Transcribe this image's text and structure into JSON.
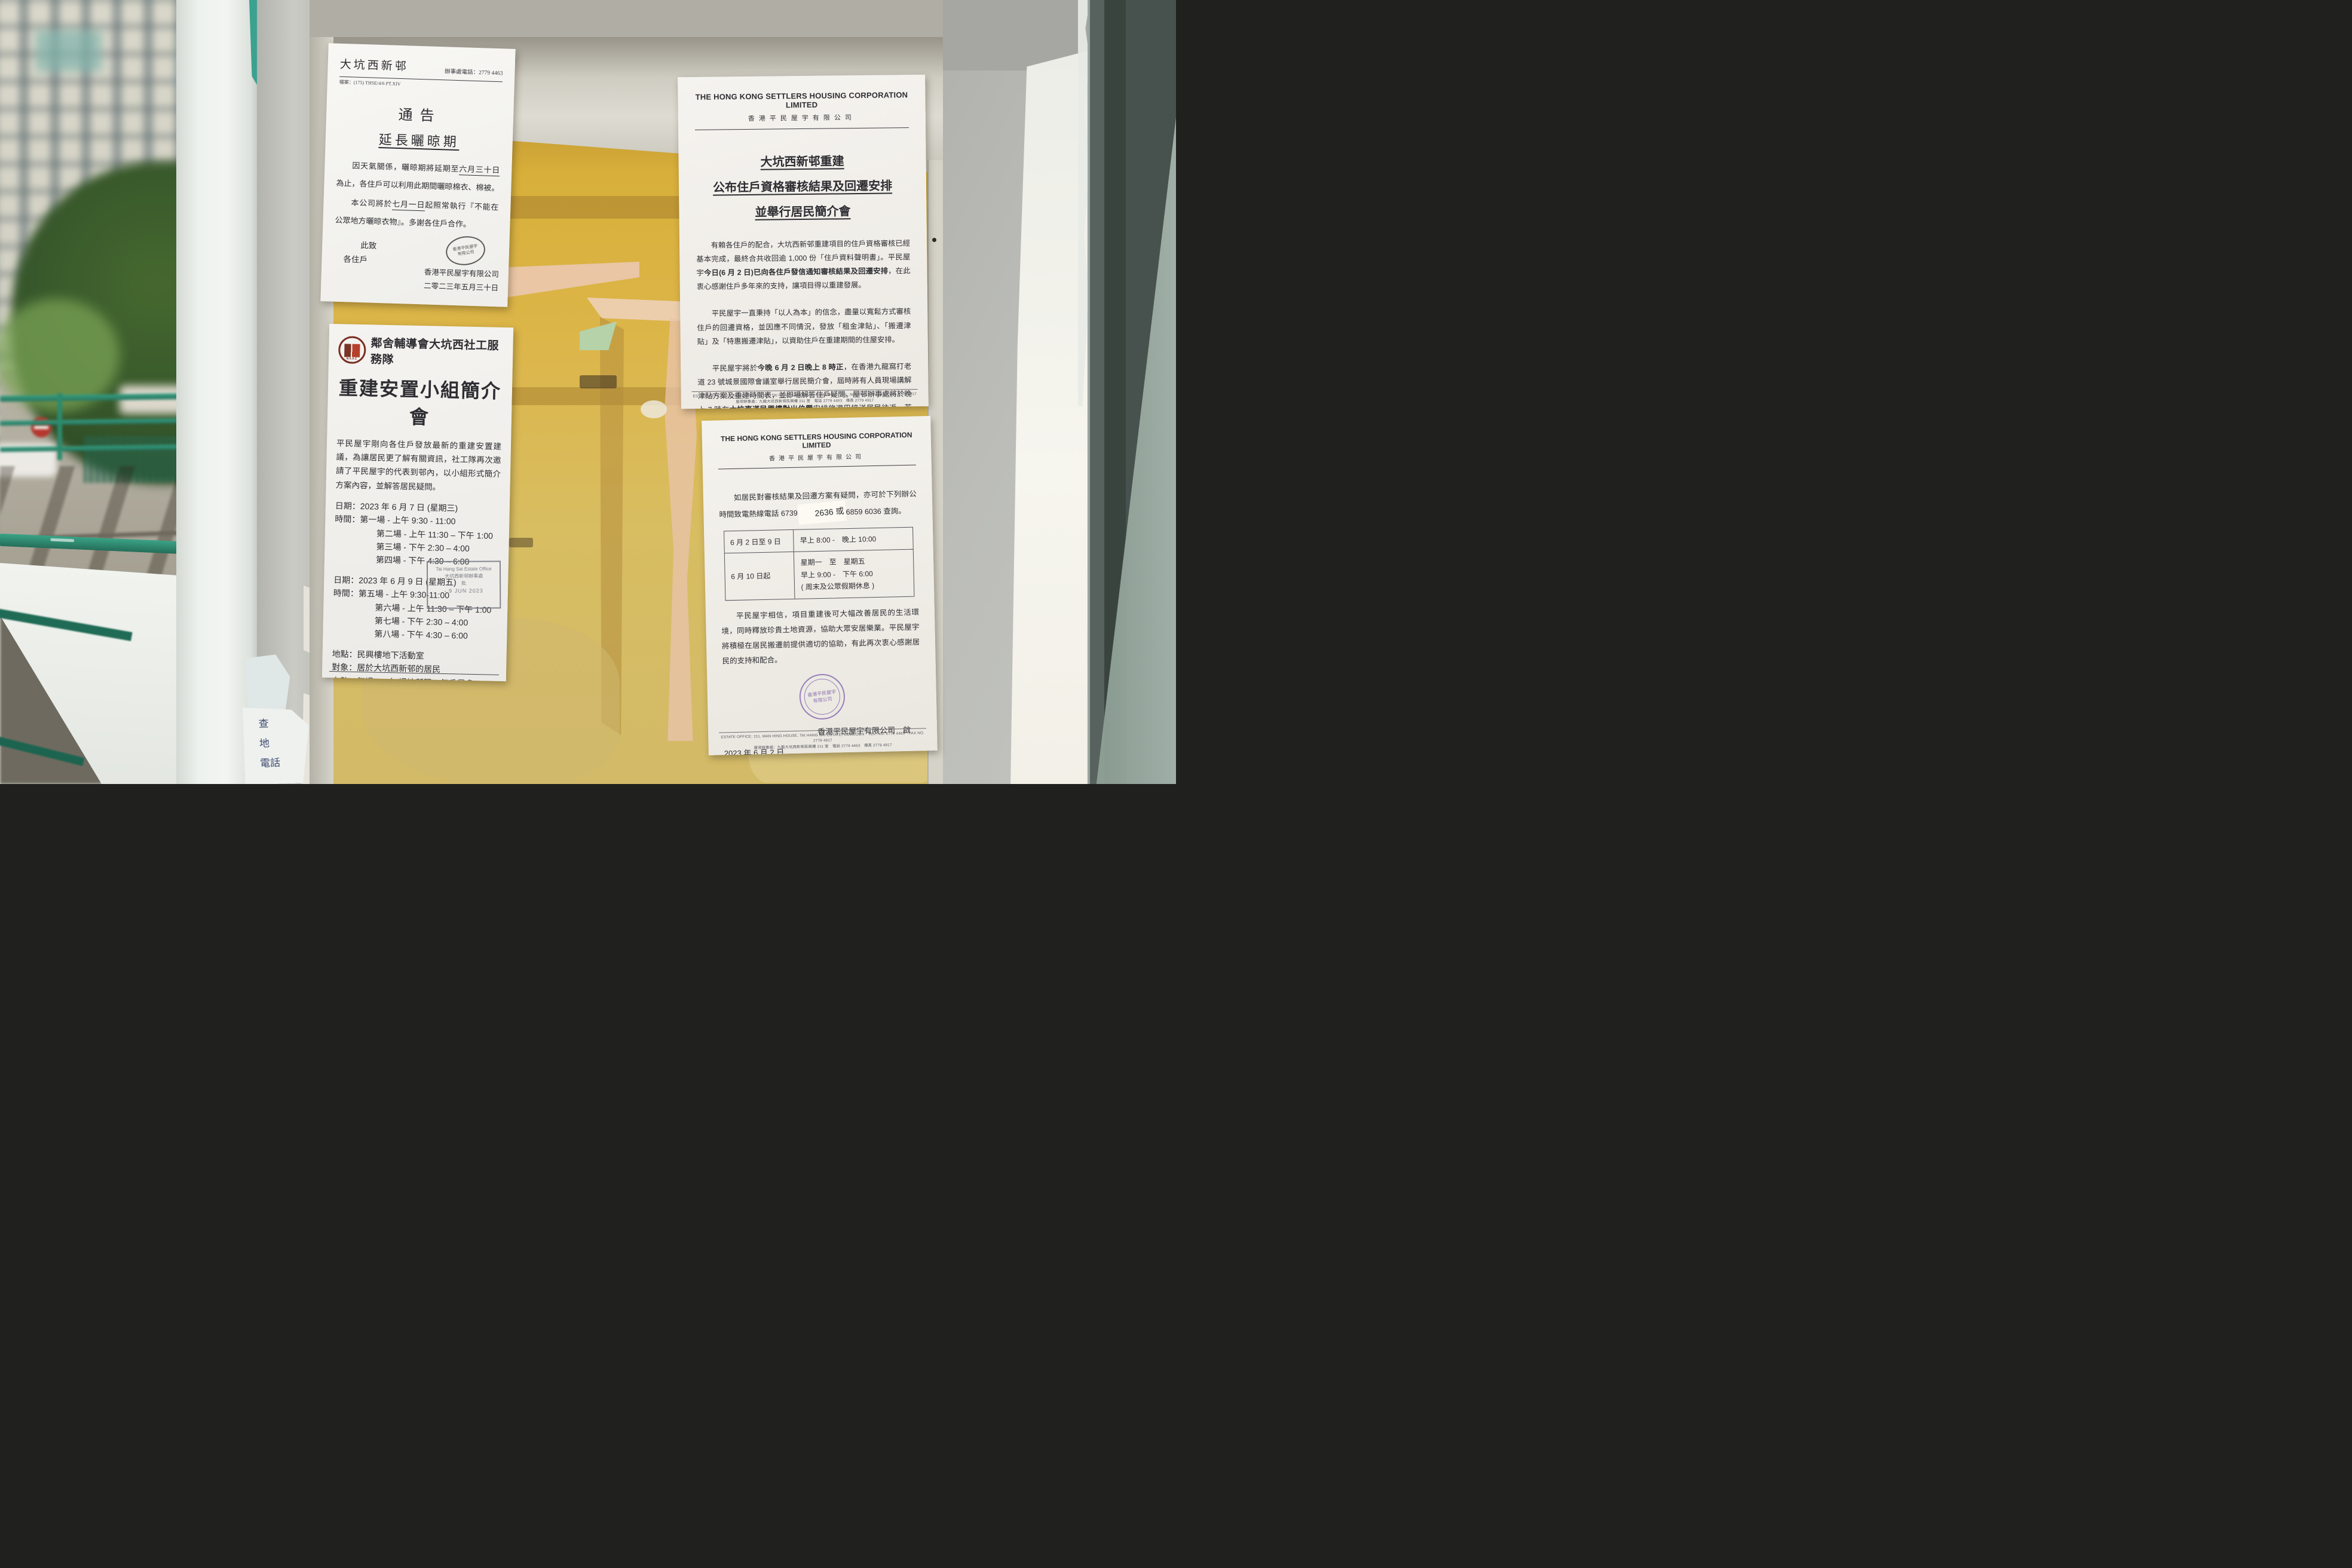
{
  "colors": {
    "board_yellow": "#dcb64a",
    "railing_green": "#2e8f72",
    "paper_white": "#f6f5f1",
    "stamp_black": "#3f3f3f",
    "stamp_purple": "#7b5ea6",
    "no_entry_red": "#b5372f",
    "doorframe_teal": "#47524e"
  },
  "notice_drying": {
    "estate_name": "大坑西新邨",
    "office_phone": "辦事處電話：2779 4463",
    "file_ref": "檔案：(175) THSE/4/6 PT.XIV",
    "title": "通告",
    "subtitle": "延長曬晾期",
    "p1_pre": "因天氣關係，曬晾期將延期至",
    "p1_underline": "六月三十日",
    "p1_post": "為止，各住戶可以利用此期間曬晾棉衣、棉被。",
    "p2_pre": "本公司將於",
    "p2_underline": "七月一日",
    "p2_post": "起照常執行『不能在公眾地方曬晾衣物』。多謝各住戶合作。",
    "closing_1": "此致",
    "closing_2": "各住戶",
    "stamp_line1": "香港平民屋宇",
    "stamp_line2": "有限公司",
    "signature": "香港平民屋宇有限公司",
    "date": "二零二三年五月三十日"
  },
  "notice_briefing": {
    "org": "鄰舍輔導會大坑西社工服務隊",
    "logo_caption": "NAAC",
    "title": "重建安置小組簡介會",
    "intro": "平民屋宇剛向各住戶發放最新的重建安置建議，為讓居民更了解有關資訊，社工隊再次邀請了平民屋宇的代表到邨內，以小組形式簡介方案內容，並解答居民疑問。",
    "day1_date": "日期：2023 年 6 月 7 日 (星期三)",
    "day1_sessions": [
      "時間：第一場 - 上午 9:30 - 11:00",
      "第二場 - 上午 11:30 – 下午 1:00",
      "第三場 - 下午 2:30 – 4:00",
      "第四場 - 下午 4:30 – 6:00"
    ],
    "day2_date": "日期：2023 年 6 月 9 日 (星期五)",
    "day2_sessions": [
      "時間：第五場 - 上午 9:30-11:00",
      "第六場 - 上午 11:30 – 下午 1:00",
      "第七場 - 下午 2:30 – 4:00",
      "第八場 - 下午 4:30 – 6:00"
    ],
    "venue": "地點：民興樓地下活動室",
    "audience": "對象：居於大坑西新邨的居民",
    "capacity_pre": "人數：每場 35 人(場地所限，每戶最多 2 人，",
    "capacity_boxed": "請先預約",
    "capacity_post": ")",
    "note": "註　：未有出席 6 月 5 日簡介會之住戶，可優先出席。",
    "enquiry": "查詢及預約：",
    "address": "地址：九龍深水埗大坑西新邨民樂樓 116 室",
    "phone": "電話：9719 9107",
    "stamp": {
      "line1": "Tai Hang Sai Estate Office",
      "line2": "大坑西新邨辦事處",
      "line3": "批",
      "line4": "- 9 JUN 2023"
    }
  },
  "notice_results": {
    "org_en": "THE HONG KONG SETTLERS HOUSING CORPORATION LIMITED",
    "org_zh": "香港平民屋宇有限公司",
    "title_l1": "大坑西新邨重建",
    "title_l2": "公布住戶資格審核結果及回遷安排",
    "title_l3": "並舉行居民簡介會",
    "p1_pre": "有賴各住戶的配合，大坑西新邨重建項目的住戶資格審核已經基本完成，最終合共收回逾 1,000 份「住戶資料聲明書」。平民屋宇",
    "p1_bold": "今日(6 月 2 日)已向各住戶發信通知審核結果及回遷安排",
    "p1_post": "，在此衷心感謝住戶多年來的支持，讓項目得以重建發展。",
    "p2": "平民屋宇一直秉持「以人為本」的信念，盡量以寬鬆方式審核住戶的回遷資格，並因應不同情況，發放「租金津貼」、「搬遷津貼」及「特惠搬遷津貼」，以資助住戶在重建期間的住屋安排。",
    "p3_pre": "平民屋宇將於",
    "p3_bold1": "今晚 6 月 2 日晚上 8 時正",
    "p3_mid": "，在香港九龍窩打老道 23 號城景國際會議室舉行居民簡介會，屆時將有人員現場講解津貼方案及重建時間表，並即場解答住戶疑問。屋邨辦事處將於晚上 7 時在",
    "p3_bold2": "大坑東道民興樓對出位置",
    "p3_post": "安排旅遊巴接送居民往返。若需了解進一步詳情，可與屋邨辦事處聯絡，電話 2779 4463。",
    "footer_en": "ESTATE OFFICE: 211, MAN HING HOUSE, TAI HANG SAI ESTATE, KOWLOON　TEL. NO. 2779 4463　FAX NO. 2779 4917",
    "footer_zh": "屋邨辦事處：九龍大坑西新邨民興樓 211 室　電話 2779 4463　傳真 2779 4917"
  },
  "notice_hotline": {
    "org_en": "THE HONG KONG SETTLERS HOUSING CORPORATION LIMITED",
    "org_zh": "香港平民屋宇有限公司",
    "p1_pre": "如居民對審核結果及回遷方案有疑問，亦可於下列辦公時間致電熱線電話 6739 ",
    "p1_sticker": "2636 或",
    "p1_post": " 6859 6036 查詢。",
    "table": {
      "r1c1": "6 月 2 日至 9 日",
      "r1c2": "早上 8:00 -　晚上 10:00",
      "r2c1": "6 月 10 日起",
      "r2c2_l1": "星期一　至　星期五",
      "r2c2_l2": "早上 9:00 -　下午 6:00",
      "r2c2_l3": "( 周末及公眾假期休息 )"
    },
    "p2": "平民屋宇相信，項目重建後可大幅改善居民的生活環境，同時釋放珍貴土地資源，協助大眾安居樂業。平民屋宇將積極在居民搬遷前提供適切的協助，有此再次衷心感謝居民的支持和配合。",
    "stamp_line1": "香港平民屋宇",
    "stamp_line2": "有限公司",
    "signature": "香港平民屋宇有限公司　啟",
    "date": "2023 年 6 月 2 日",
    "footer_en": "ESTATE OFFICE: 211, MAN HING HOUSE, TAI HANG SAI ESTATE, KOWLOON　TEL. NO. 2779 4463　FAX NO. 2779 4917",
    "footer_zh": "屋邨辦事處：九龍大坑西新邨民興樓 211 室　電話 2779 4463　傳真 2779 4917"
  },
  "scrap": {
    "l1": "查",
    "l2": "地",
    "l3": "電話"
  }
}
